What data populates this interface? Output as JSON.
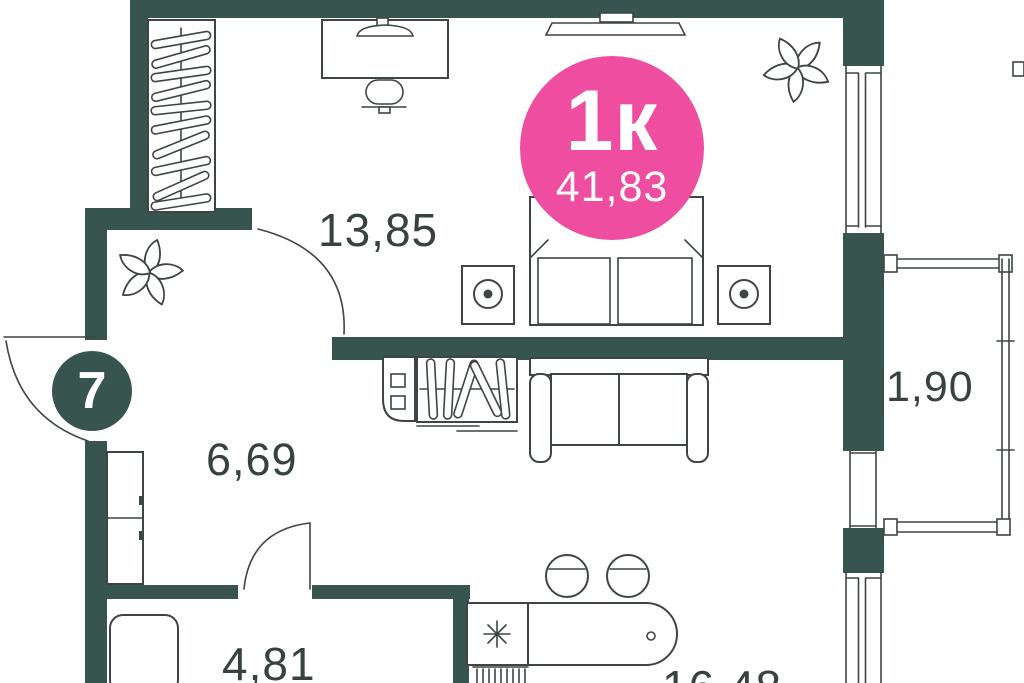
{
  "unit": {
    "number": "7",
    "type_label": "1к",
    "total_area": "41,83"
  },
  "rooms": {
    "bedroom": {
      "area": "13,85"
    },
    "hall": {
      "area": "6,69"
    },
    "bathroom": {
      "area": "4,81"
    },
    "kitchen_living": {
      "area": "16,48"
    },
    "balcony": {
      "area": "1,90"
    }
  },
  "colors": {
    "wall": "#37544e",
    "accent_pink": "#ee4da0",
    "line": "#3e4543",
    "label_text": "#3a4240",
    "background": "#ffffff"
  }
}
